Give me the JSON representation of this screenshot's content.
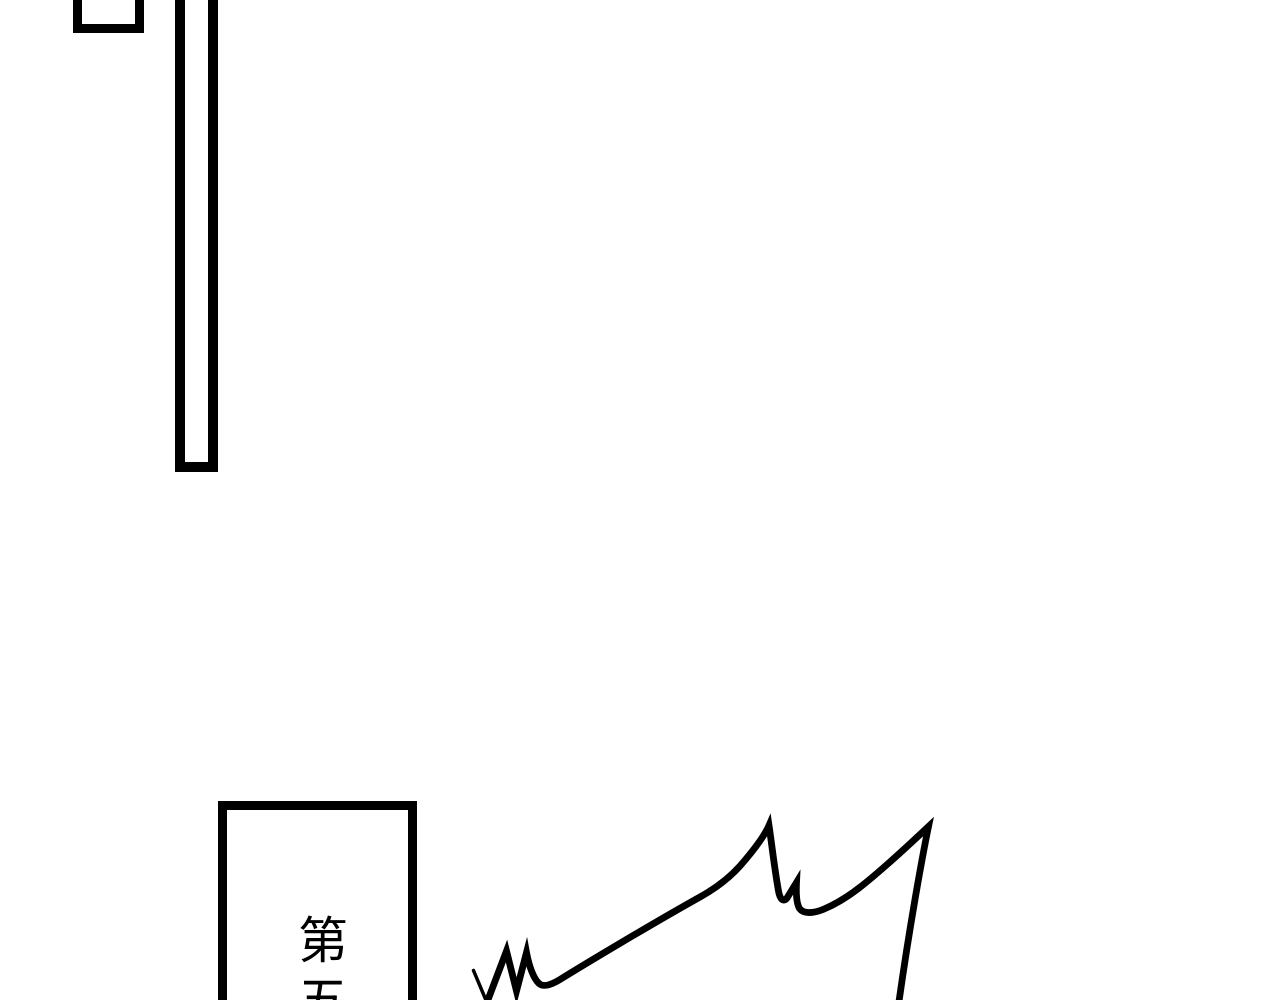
{
  "colors": {
    "background": "#ffffff",
    "ink": "#000000"
  },
  "chapter_box": {
    "text": "第五"
  }
}
